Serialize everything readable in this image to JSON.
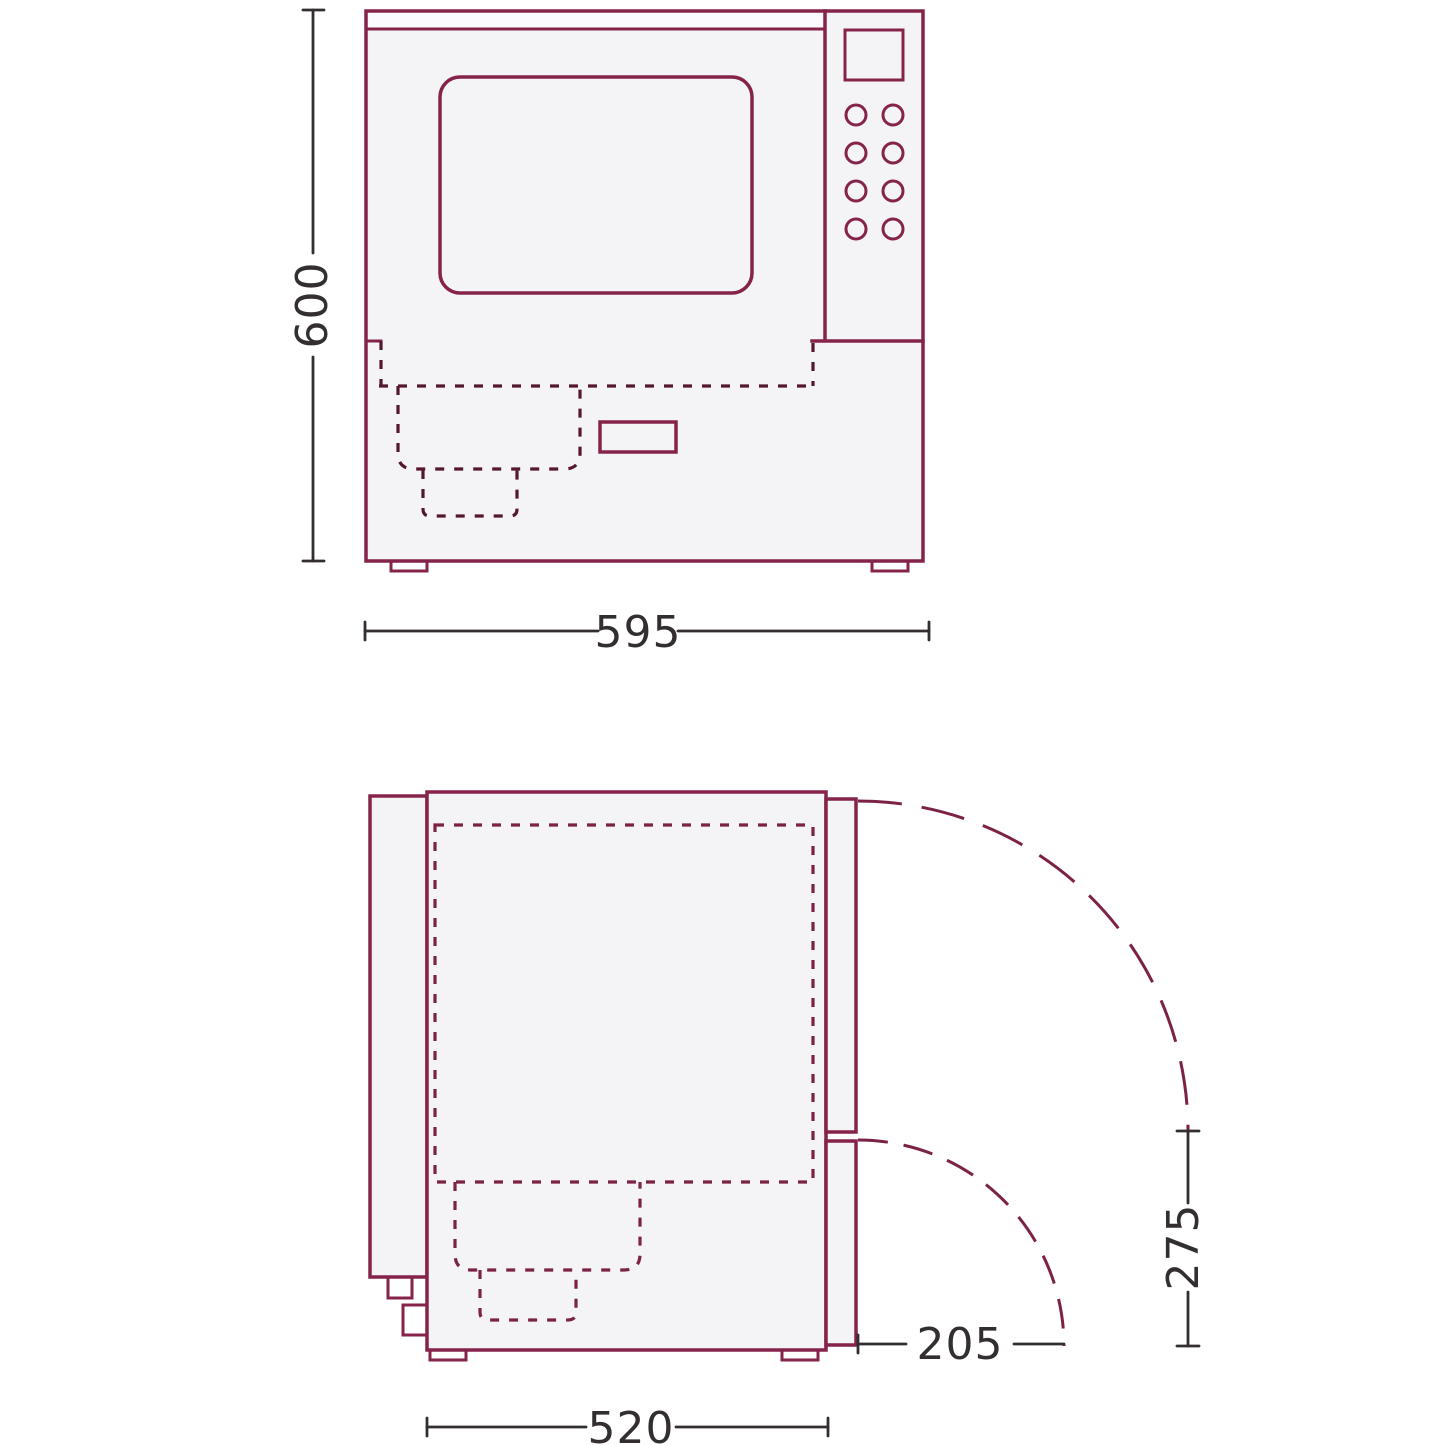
{
  "dimensions": {
    "front_height": "600",
    "front_width": "595",
    "side_depth": "520",
    "door_swing_upper": "275",
    "door_swing_lower": "205"
  },
  "colors": {
    "outline": "#85234a",
    "dashed": "#7b2246",
    "dashed_front": "#551730",
    "dimension": "#332e31",
    "fill": "#f4f4f7",
    "window_fill": "#f6f6fa",
    "strip": "#fafaff",
    "background": "#ffffff"
  }
}
